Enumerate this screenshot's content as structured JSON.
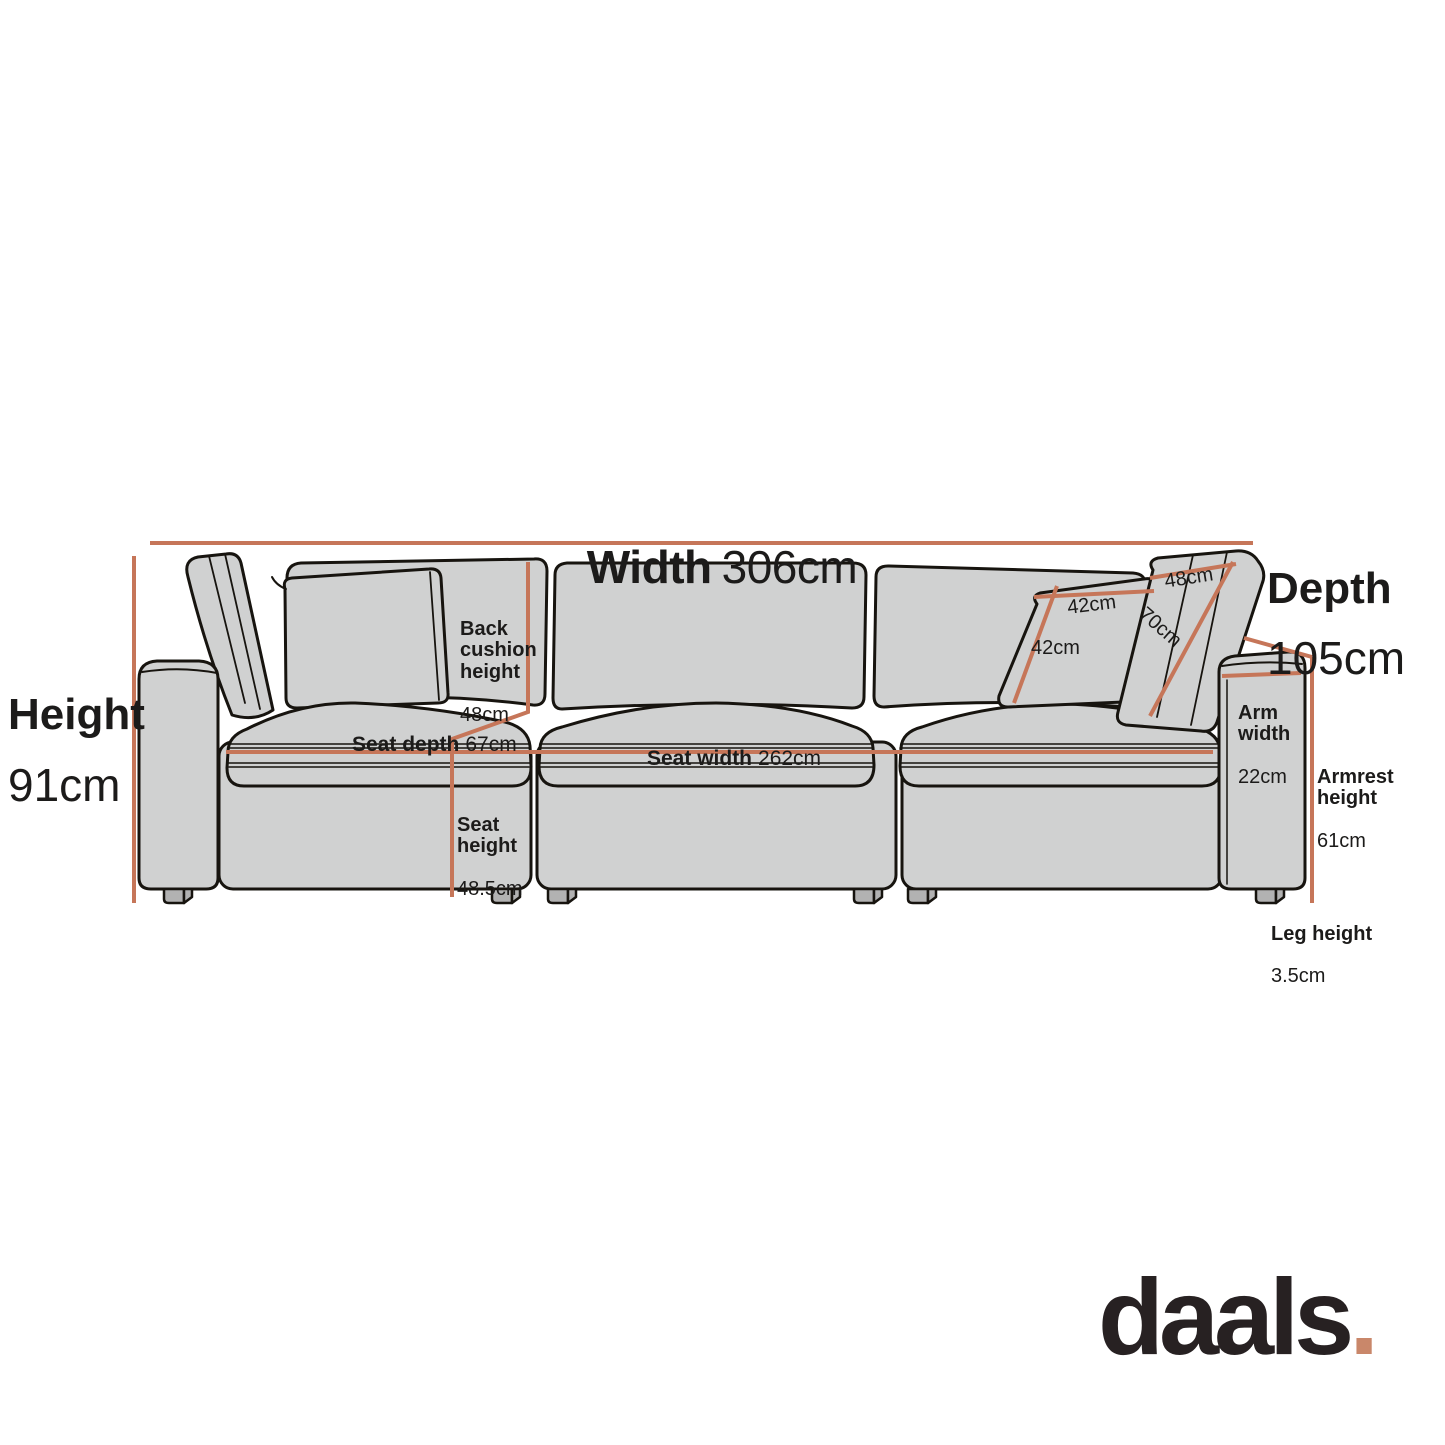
{
  "diagram": {
    "title": "Sofa dimension diagram",
    "colors": {
      "accent_line": "#c67659",
      "sofa_fill": "#d0d1d1",
      "sofa_outline": "#17140f",
      "leg_fill": "#b2b2b2",
      "text": "#1c1b1a",
      "logo_text": "#272122",
      "logo_dot": "#c9876a"
    },
    "dimensions": {
      "width": {
        "label": "Width",
        "value": "306cm"
      },
      "depth": {
        "label": "Depth",
        "value": "105cm"
      },
      "height": {
        "label": "Height",
        "value": "91cm"
      },
      "back_cushion_height": {
        "label": "Back\ncushion\nheight",
        "value": "48cm"
      },
      "seat_depth": {
        "label": "Seat depth",
        "value": "67cm"
      },
      "seat_width": {
        "label": "Seat width",
        "value": "262cm"
      },
      "seat_height": {
        "label": "Seat\nheight",
        "value": "48.5cm"
      },
      "arm_width": {
        "label": "Arm\nwidth",
        "value": "22cm"
      },
      "armrest_height": {
        "label": "Armrest\nheight",
        "value": "61cm"
      },
      "leg_height": {
        "label": "Leg height",
        "value": "3.5cm"
      },
      "pillow_width": {
        "value": "42cm"
      },
      "pillow_height": {
        "value": "42cm"
      },
      "back_cushion_width": {
        "value": "48cm"
      },
      "back_cushion_length": {
        "value": "70cm"
      }
    }
  },
  "logo": {
    "text": "daals",
    "dot": "."
  }
}
